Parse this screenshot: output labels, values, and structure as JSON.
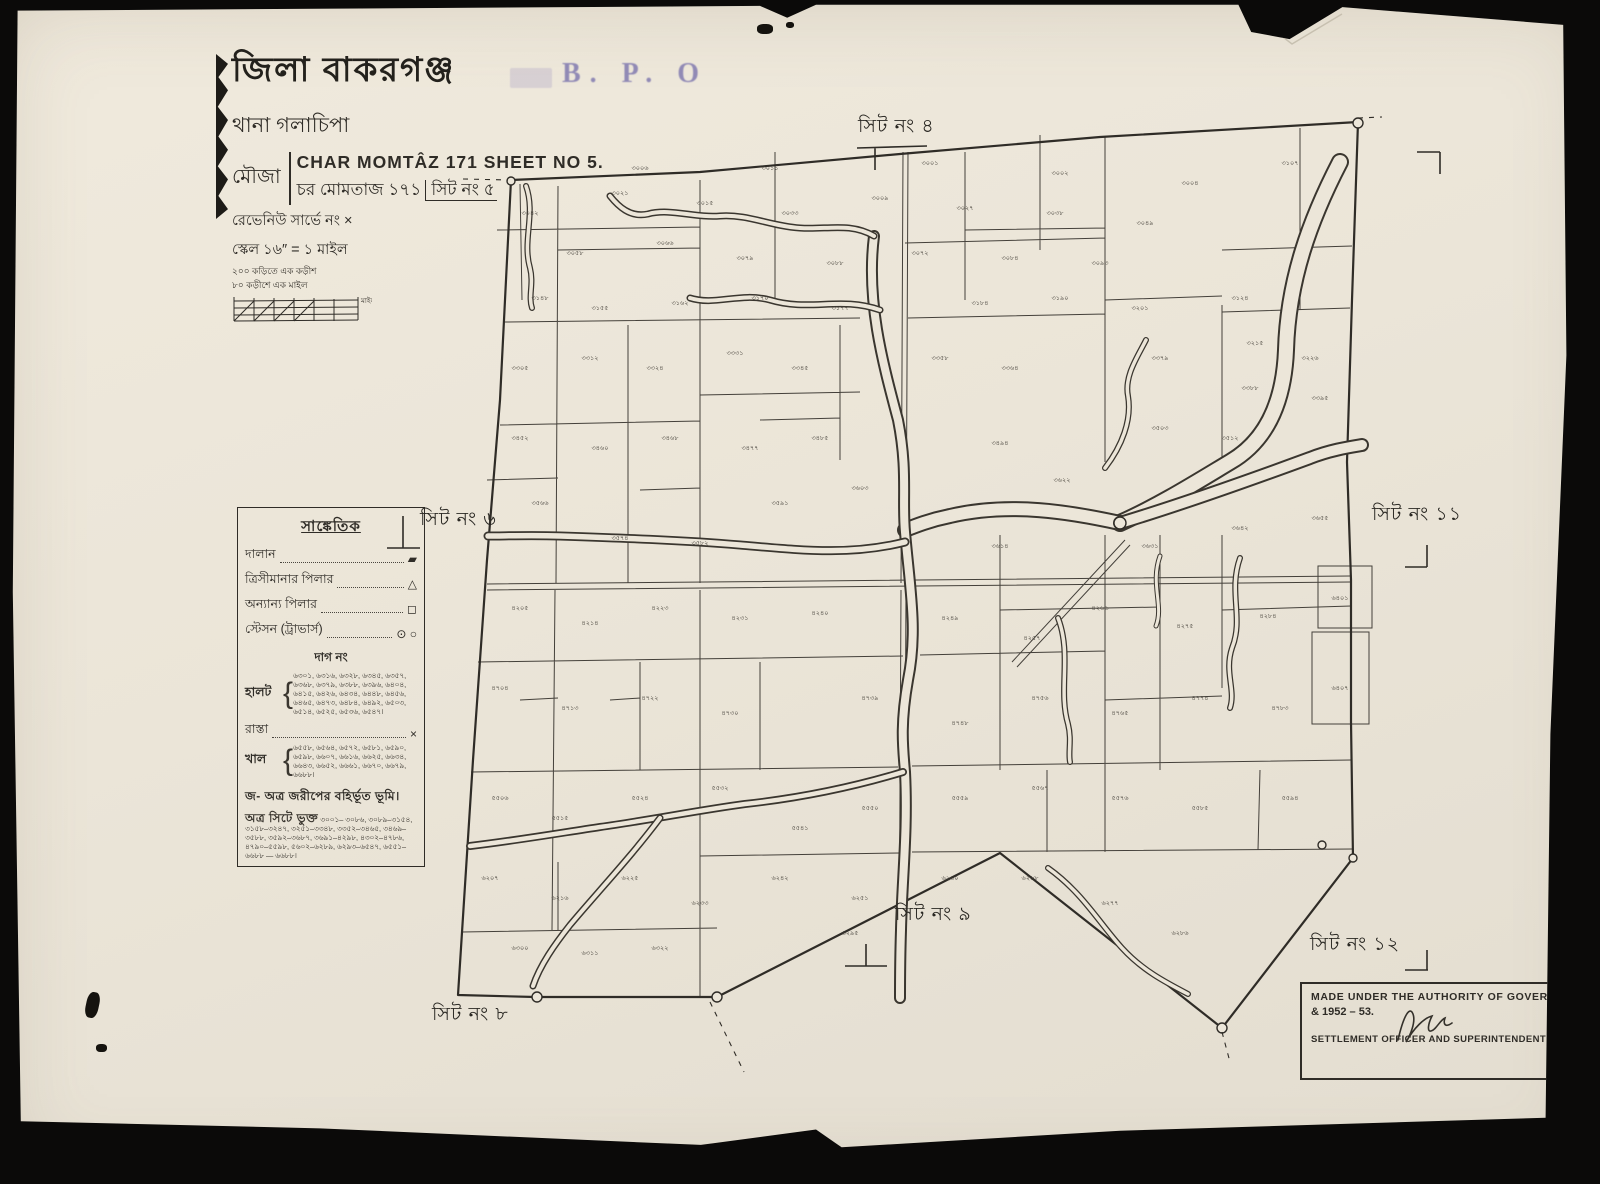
{
  "title_block": {
    "district": "জিলা বাকরগঞ্জ",
    "thana": "থানা গলাচিপা",
    "mouza_label": "মৌজা",
    "mouza_en": "CHAR MOMTÂZ 171 SHEET NO 5.",
    "mouza_bn": "চর মোমতাজ ১৭১",
    "mouza_bn_sheet": "সিট নং ৫",
    "revenue_survey": "রেভেনিউ সার্ভে নং ×",
    "scale": "স্কেল ১৬″ = ১ মাইল",
    "scale_note_1": "২০০ কড়িতে এক কড়ীশ",
    "scale_note_2": "৮০ কড়ীশে এক মাইল",
    "scale_bar_unit": "মাইল"
  },
  "stamp": {
    "text": "B. P. O"
  },
  "sheet_labels": {
    "top": "সিট নং ৪",
    "left": "সিট নং ৬",
    "right": "সিট নং ১১",
    "bottom_middle": "সিট নং ৯",
    "bottom_left": "সিট নং ৮",
    "bottom_right": "সিট নং ১২"
  },
  "legend": {
    "title": "সাঙ্কেতিক",
    "rows": [
      {
        "label": "দালান",
        "symbol": "▰"
      },
      {
        "label": "ত্রিসীমানার পিলার",
        "symbol": "△"
      },
      {
        "label": "অন্যান্য পিলার",
        "symbol": "◻"
      },
      {
        "label": "স্টেসন (ট্রাভার্স)",
        "symbol": "⊙ ○"
      }
    ],
    "dag_heading": "দাগ নং",
    "halot_label": "হালট",
    "halot_numbers": "৬৩০১, ৬৩১৬, ৬৩২৮, ৬৩৪৫, ৬৩৫৭, ৬৩৬৮, ৬৩৭৯, ৬৩৮৮, ৬৩৯৬, ৬৪০৪, ৬৪১৫, ৬৪২৬, ৬৪৩৪, ৬৪৪৮, ৬৪৫৬, ৬৪৬৫, ৬৪৭৩, ৬৪৮৪, ৬৪৯২, ৬৫০৩, ৬৫১৪, ৬৫২৫, ৬৫৩৬, ৬৫৪৭।",
    "rasta_label": "রাস্তা",
    "rasta_symbol": "×",
    "khal_label": "খাল",
    "khal_numbers": "৬৫৫৮, ৬৫৬৪, ৬৫৭২, ৬৫৮১, ৬৫৯০, ৬৫৯৮, ৬৬০৭, ৬৬১৬, ৬৬২৫, ৬৬৩৪, ৬৬৪৩, ৬৬৫২, ৬৬৬১, ৬৬৭০, ৬৬৭৯, ৬৬৮৮।",
    "exclusion_note": "জ- অত্র জরীপের বহির্ভূত ভূমি।",
    "included_label": "অত্র সিটে ভুক্ত",
    "included_numbers": "৩০০১– ৩০৮৬, ৩০৮৯–৩১৫৪, ৩১৫৮–৩২৪৭, ৩২৫১–৩৩৪৮, ৩৩৫২–৩৪৬৫, ৩৪৬৯–৩৫৮৮, ৩৫৯২–৩৬৮৭, ৩৬৯১–৪২৯৮, ৪৩০২–৪৭৮৬, ৪৭৯০–৫৫৯৮, ৫৬০২–৬২৮৯, ৬২৯৩–৬৫৪৭, ৬৫৫১–৬৬৮৮ — ৬৬৮৮।"
  },
  "authority": {
    "line1": "MADE UNDER THE AUTHORITY OF GOVERNMENT",
    "line2": "& 1952 – 53.",
    "line3": "SETTLEMENT OFFICER AND SUPERINTENDENT OF SURVEY"
  },
  "map": {
    "plot_labels": [
      [
        530,
        215,
        "৩০৪২"
      ],
      [
        575,
        255,
        "৩০৫৮"
      ],
      [
        620,
        195,
        "৩০২১"
      ],
      [
        665,
        245,
        "৩০৬৬"
      ],
      [
        705,
        205,
        "৩০১৫"
      ],
      [
        745,
        260,
        "৩০৭৯"
      ],
      [
        790,
        215,
        "৩০৩৩"
      ],
      [
        835,
        265,
        "৩০৮৮"
      ],
      [
        880,
        200,
        "৩০০৯"
      ],
      [
        920,
        255,
        "৩০৭২"
      ],
      [
        965,
        210,
        "৩০২৭"
      ],
      [
        1010,
        260,
        "৩০৮৪"
      ],
      [
        1055,
        215,
        "৩০৩৮"
      ],
      [
        1100,
        265,
        "৩০৯৩"
      ],
      [
        1145,
        225,
        "৩০৪৯"
      ],
      [
        1190,
        185,
        "৩০০৪"
      ],
      [
        1240,
        300,
        "৩১২৪"
      ],
      [
        1290,
        165,
        "৩১০৭"
      ],
      [
        1060,
        175,
        "৩০০২"
      ],
      [
        930,
        165,
        "৩০০১"
      ],
      [
        770,
        170,
        "৩০১১"
      ],
      [
        640,
        170,
        "৩০০৬"
      ],
      [
        540,
        300,
        "৩১৪৮"
      ],
      [
        600,
        310,
        "৩১৫৫"
      ],
      [
        680,
        305,
        "৩১৬২"
      ],
      [
        760,
        300,
        "৩১৭০"
      ],
      [
        840,
        310,
        "৩১৭৭"
      ],
      [
        980,
        305,
        "৩১৮৪"
      ],
      [
        1060,
        300,
        "৩১৯০"
      ],
      [
        1140,
        310,
        "৩২০১"
      ],
      [
        1255,
        345,
        "৩২১৫"
      ],
      [
        1310,
        360,
        "৩২২৬"
      ],
      [
        520,
        370,
        "৩৩০৫"
      ],
      [
        590,
        360,
        "৩৩১২"
      ],
      [
        655,
        370,
        "৩৩২৪"
      ],
      [
        735,
        355,
        "৩৩৩১"
      ],
      [
        800,
        370,
        "৩৩৪৫"
      ],
      [
        940,
        360,
        "৩৩৫৮"
      ],
      [
        1010,
        370,
        "৩৩৬৪"
      ],
      [
        1160,
        360,
        "৩৩৭৯"
      ],
      [
        1250,
        390,
        "৩৩৮৮"
      ],
      [
        1320,
        400,
        "৩৩৯৫"
      ],
      [
        520,
        440,
        "৩৪৫২"
      ],
      [
        600,
        450,
        "৩৪৬০"
      ],
      [
        670,
        440,
        "৩৪৬৮"
      ],
      [
        750,
        450,
        "৩৪৭৭"
      ],
      [
        820,
        440,
        "৩৪৮৫"
      ],
      [
        1000,
        445,
        "৩৪৯৪"
      ],
      [
        1160,
        430,
        "৩৫০৩"
      ],
      [
        1230,
        440,
        "৩৫১২"
      ],
      [
        540,
        505,
        "৩৫৬৬"
      ],
      [
        620,
        540,
        "৩৫৭৪"
      ],
      [
        700,
        545,
        "৩৫৮২"
      ],
      [
        780,
        505,
        "৩৫৯১"
      ],
      [
        860,
        490,
        "৩৬০৩"
      ],
      [
        1000,
        548,
        "৩৬১৪"
      ],
      [
        1062,
        482,
        "৩৬২২"
      ],
      [
        1150,
        548,
        "৩৬৩১"
      ],
      [
        1240,
        530,
        "৩৬৪২"
      ],
      [
        1320,
        520,
        "৩৬৫৫"
      ],
      [
        520,
        610,
        "৪২০৫"
      ],
      [
        590,
        625,
        "৪২১৪"
      ],
      [
        660,
        610,
        "৪২২৩"
      ],
      [
        740,
        620,
        "৪২৩১"
      ],
      [
        820,
        615,
        "৪২৪০"
      ],
      [
        950,
        620,
        "৪২৪৯"
      ],
      [
        1032,
        640,
        "৪২৫৭"
      ],
      [
        1100,
        610,
        "৪২৬৬"
      ],
      [
        1185,
        628,
        "৪২৭৫"
      ],
      [
        1268,
        618,
        "৪২৮৪"
      ],
      [
        1340,
        600,
        "৬৪০১"
      ],
      [
        500,
        690,
        "৪৭০৪"
      ],
      [
        570,
        710,
        "৪৭১৩"
      ],
      [
        650,
        700,
        "৪৭২২"
      ],
      [
        730,
        715,
        "৪৭৩০"
      ],
      [
        870,
        700,
        "৪৭৩৯"
      ],
      [
        960,
        725,
        "৪৭৪৮"
      ],
      [
        1040,
        700,
        "৪৭৫৬"
      ],
      [
        1120,
        715,
        "৪৭৬৫"
      ],
      [
        1200,
        700,
        "৪৭৭৪"
      ],
      [
        1280,
        710,
        "৪৭৮৩"
      ],
      [
        1340,
        690,
        "৬৪০৭"
      ],
      [
        500,
        800,
        "৫৫০৬"
      ],
      [
        560,
        820,
        "৫৫১৫"
      ],
      [
        640,
        800,
        "৫৫২৪"
      ],
      [
        720,
        790,
        "৫৫৩২"
      ],
      [
        800,
        830,
        "৫৫৪১"
      ],
      [
        870,
        810,
        "৫৫৫০"
      ],
      [
        960,
        800,
        "৫৫৫৯"
      ],
      [
        1040,
        790,
        "৫৫৬৭"
      ],
      [
        1120,
        800,
        "৫৫৭৬"
      ],
      [
        1200,
        810,
        "৫৫৮৫"
      ],
      [
        1290,
        800,
        "৫৫৯৪"
      ],
      [
        490,
        880,
        "৬২০৭"
      ],
      [
        560,
        900,
        "৬২১৬"
      ],
      [
        630,
        880,
        "৬২২৫"
      ],
      [
        700,
        905,
        "৬২৩৩"
      ],
      [
        780,
        880,
        "৬২৪২"
      ],
      [
        860,
        900,
        "৬২৫১"
      ],
      [
        950,
        880,
        "৬২৬০"
      ],
      [
        1030,
        880,
        "৬২৬৮"
      ],
      [
        1110,
        905,
        "৬২৭৭"
      ],
      [
        1180,
        935,
        "৬২৮৬"
      ],
      [
        520,
        950,
        "৬৩০০"
      ],
      [
        590,
        955,
        "৬৩১১"
      ],
      [
        660,
        950,
        "৬৩২২"
      ],
      [
        850,
        935,
        "৬২৯৫"
      ]
    ]
  }
}
